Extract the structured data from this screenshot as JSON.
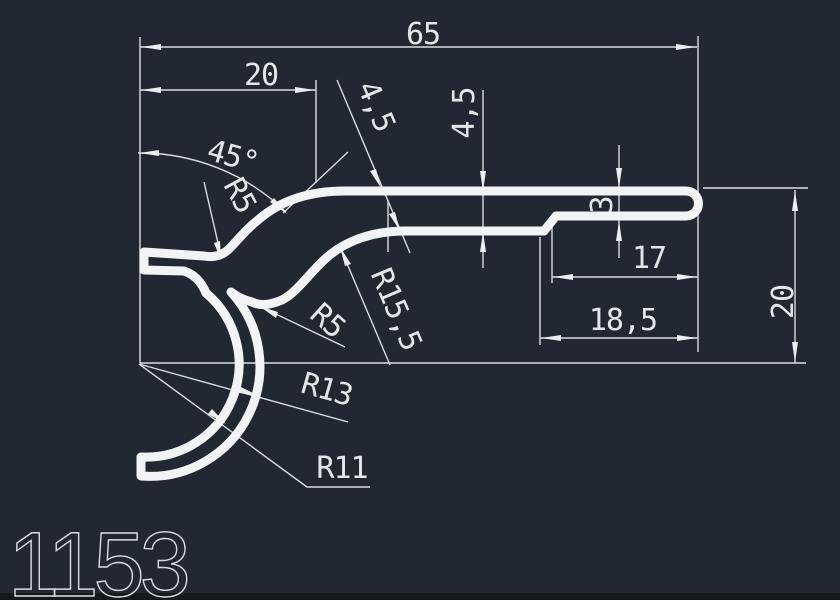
{
  "drawing": {
    "part_number": "1153",
    "labels": {
      "overall_width": "65",
      "top_offset": "20",
      "angle": "45°",
      "radius_top": "R5",
      "thickness_diag": "4,5",
      "thickness_vert": "4,5",
      "gap": "3",
      "bend_radius": "R15,5",
      "radius_mid": "R5",
      "tail_length": "17",
      "tail_length_2": "18,5",
      "height_right": "20",
      "radius_outer": "R13",
      "radius_inner": "R11"
    },
    "colors": {
      "background": "#222831",
      "geometry": "#f1f3f5",
      "dimension_lines": "#d7dde2",
      "text": "#e3e7ea"
    }
  }
}
